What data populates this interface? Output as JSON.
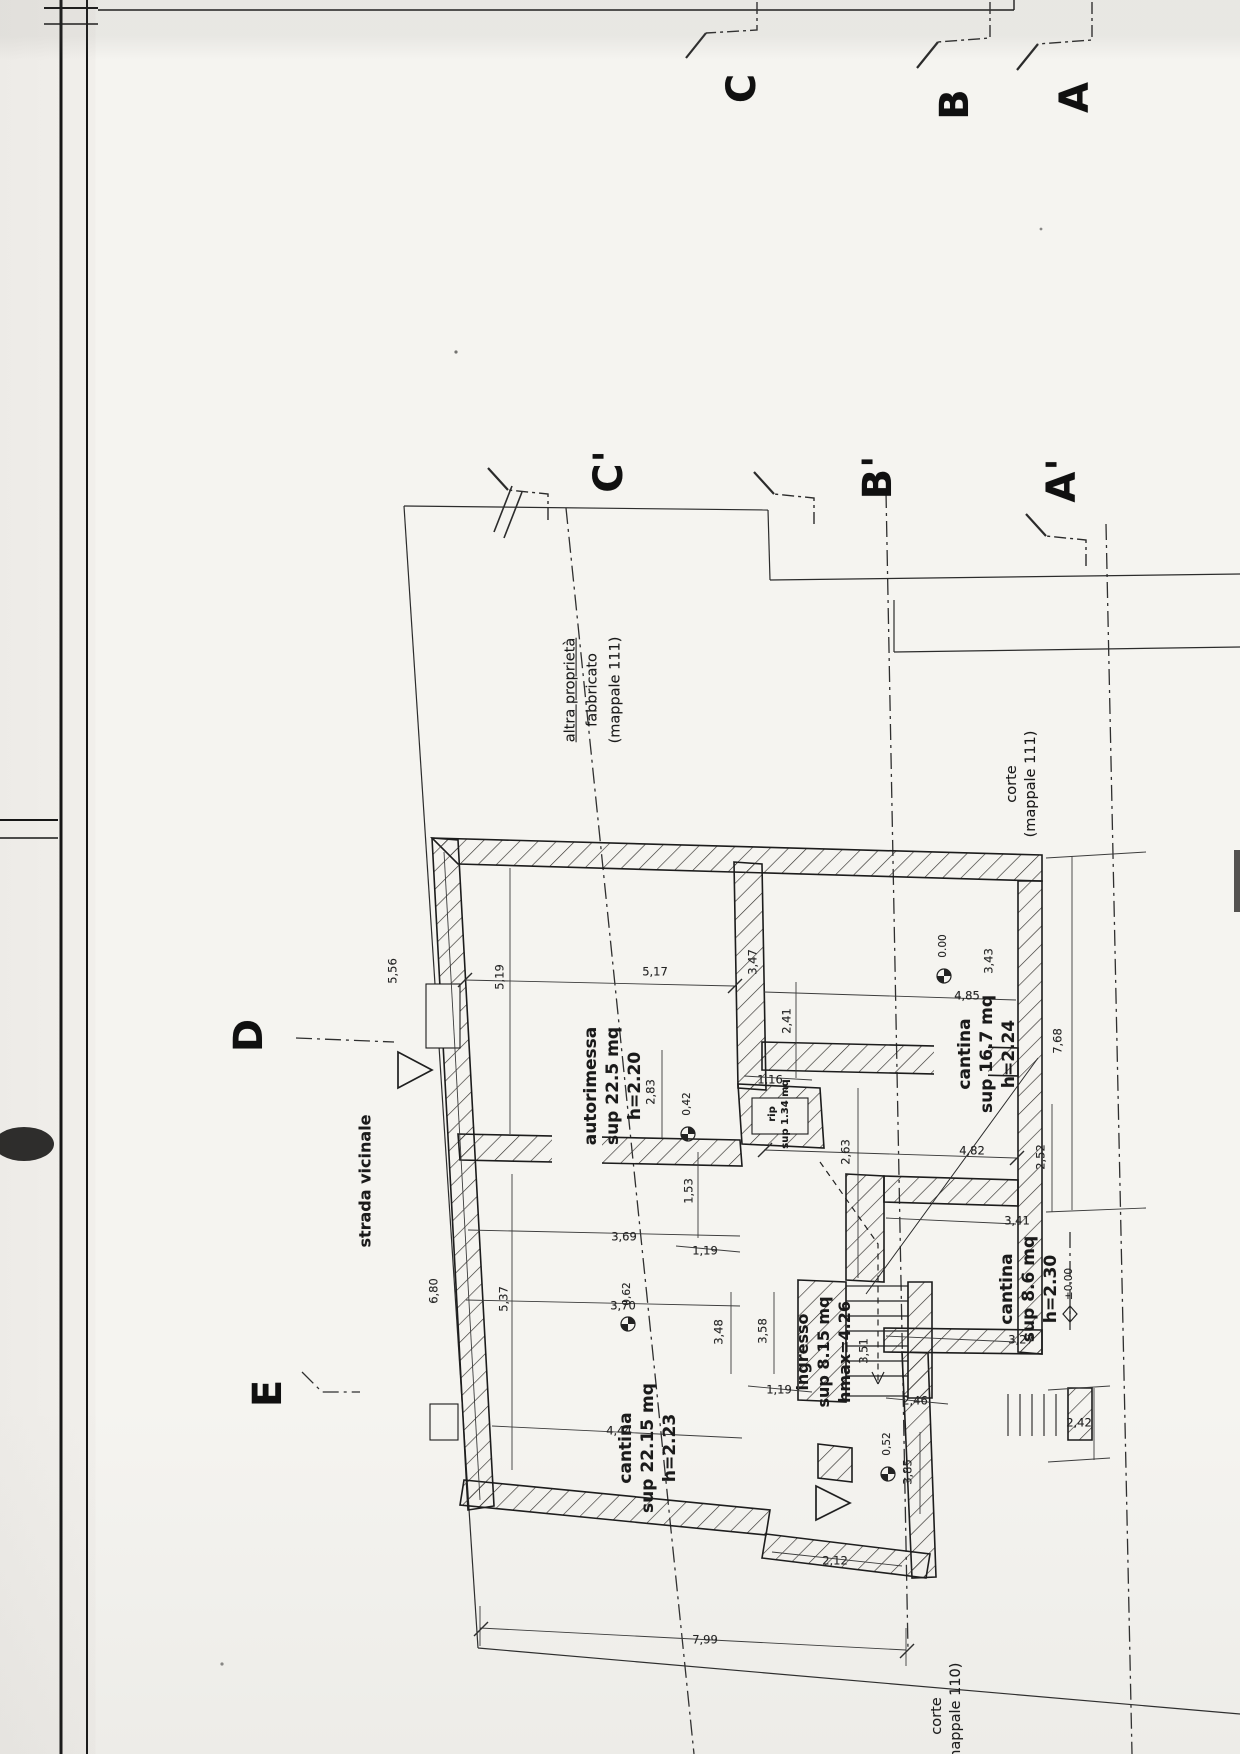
{
  "colors": {
    "paper": "#f5f4f0",
    "ink": "#1a1a1a",
    "line": "#2e2e2e"
  },
  "drawing": {
    "section_letters": [
      {
        "n": "section-letter-c",
        "t": "C",
        "x": 742,
        "y": 88
      },
      {
        "n": "section-letter-b",
        "t": "B",
        "x": 955,
        "y": 104
      },
      {
        "n": "section-letter-a",
        "t": "A",
        "x": 1075,
        "y": 97
      },
      {
        "n": "section-letter-c-prime",
        "t": "C'",
        "x": 609,
        "y": 471
      },
      {
        "n": "section-letter-b-prime",
        "t": "B'",
        "x": 878,
        "y": 477
      },
      {
        "n": "section-letter-a-prime",
        "t": "A'",
        "x": 1062,
        "y": 480
      },
      {
        "n": "section-letter-d",
        "t": "D",
        "x": 249,
        "y": 1035
      },
      {
        "n": "section-letter-e",
        "t": "E",
        "x": 268,
        "y": 1393
      }
    ],
    "rooms": [
      {
        "n": "room-label-autorimessa",
        "lines": [
          "autorimessa",
          "sup 22.5 mq",
          "h=2.20"
        ],
        "x": 613,
        "y": 1086,
        "size": 17
      },
      {
        "n": "room-label-cantina-16-7",
        "lines": [
          "cantina",
          "sup 16.7 mq",
          "h=2.24"
        ],
        "x": 987,
        "y": 1054,
        "size": 17
      },
      {
        "n": "room-label-rip",
        "lines": [
          "rip",
          "sup 1.34 mq"
        ],
        "x": 779,
        "y": 1114,
        "size": 10
      },
      {
        "n": "room-label-cantina-22-15",
        "lines": [
          "cantina",
          "sup 22.15 mq",
          "h=2.23"
        ],
        "x": 648,
        "y": 1448,
        "size": 17
      },
      {
        "n": "room-label-cantina-8-6",
        "lines": [
          "cantina",
          "sup 8.6 mq",
          "h=2.30"
        ],
        "x": 1029,
        "y": 1289,
        "size": 17
      },
      {
        "n": "room-label-ingresso",
        "lines": [
          "ingresso",
          "sup 8.15 mq",
          "hmax=4.26"
        ],
        "x": 824,
        "y": 1352,
        "size": 16
      }
    ],
    "annotations": [
      {
        "n": "label-strada-vicinale",
        "t": "strada vicinale",
        "x": 366,
        "y": 1181,
        "size": 16,
        "bold": true
      },
      {
        "n": "label-altra-proprieta-line1",
        "t": "altra proprietà",
        "x": 571,
        "y": 690,
        "size": 14.5,
        "u": true
      },
      {
        "n": "label-altra-proprieta-line2",
        "t": "fabbricato",
        "x": 593,
        "y": 690,
        "size": 14.5
      },
      {
        "n": "label-altra-proprieta-line3",
        "t": "(mappale 111)",
        "x": 616,
        "y": 690,
        "size": 14.5
      },
      {
        "n": "label-corte-mappale-111",
        "t": "corte\n(mappale 111)",
        "x": 1022,
        "y": 784,
        "size": 14.5
      },
      {
        "n": "label-corte-mappale-110",
        "t": "corte\n(mappale 110)",
        "x": 947,
        "y": 1716,
        "size": 14.5
      }
    ],
    "dimensions": [
      {
        "t": "5,56",
        "x": 393,
        "y": 971,
        "rot": -90
      },
      {
        "t": "6,80",
        "x": 434,
        "y": 1291,
        "rot": -90
      },
      {
        "t": "5,19",
        "x": 500,
        "y": 977,
        "rot": -90
      },
      {
        "t": "5,17",
        "x": 655,
        "y": 972,
        "rot": 0
      },
      {
        "t": "2,41",
        "x": 787,
        "y": 1021,
        "rot": -90
      },
      {
        "t": "3,47",
        "x": 753,
        "y": 962,
        "rot": -90
      },
      {
        "t": "4,85",
        "x": 967,
        "y": 996,
        "rot": 0
      },
      {
        "t": "3,43",
        "x": 989,
        "y": 961,
        "rot": -90
      },
      {
        "t": "7,68",
        "x": 1058,
        "y": 1041,
        "rot": -90
      },
      {
        "t": "1,16",
        "x": 770,
        "y": 1080,
        "rot": 0
      },
      {
        "t": "2,83",
        "x": 651,
        "y": 1092,
        "rot": -90
      },
      {
        "t": "4,82",
        "x": 972,
        "y": 1151,
        "rot": 0
      },
      {
        "t": "2,52",
        "x": 1041,
        "y": 1157,
        "rot": -90
      },
      {
        "t": "2,63",
        "x": 846,
        "y": 1152,
        "rot": -90
      },
      {
        "t": "1,53",
        "x": 689,
        "y": 1191,
        "rot": -90
      },
      {
        "t": "3,41",
        "x": 1017,
        "y": 1221,
        "rot": 0
      },
      {
        "t": "3,69",
        "x": 624,
        "y": 1237,
        "rot": 0
      },
      {
        "t": "1,19",
        "x": 705,
        "y": 1251,
        "rot": 0
      },
      {
        "t": "3,70",
        "x": 623,
        "y": 1306,
        "rot": 0
      },
      {
        "t": "5,37",
        "x": 504,
        "y": 1299,
        "rot": -90
      },
      {
        "t": "3,48",
        "x": 719,
        "y": 1332,
        "rot": -90
      },
      {
        "t": "3,58",
        "x": 763,
        "y": 1331,
        "rot": -90
      },
      {
        "t": "3,27",
        "x": 1021,
        "y": 1340,
        "rot": 0
      },
      {
        "t": "3,51",
        "x": 864,
        "y": 1351,
        "rot": -90
      },
      {
        "t": "1,19",
        "x": 779,
        "y": 1390,
        "rot": 0
      },
      {
        "t": "2,46",
        "x": 915,
        "y": 1401,
        "rot": 0
      },
      {
        "t": "2,42",
        "x": 1079,
        "y": 1423,
        "rot": 0
      },
      {
        "t": "4,44",
        "x": 619,
        "y": 1431,
        "rot": 0
      },
      {
        "t": "3,85",
        "x": 908,
        "y": 1472,
        "rot": -90
      },
      {
        "t": "2,12",
        "x": 835,
        "y": 1561,
        "rot": 0
      },
      {
        "t": "7,99",
        "x": 705,
        "y": 1640,
        "rot": 0
      }
    ],
    "levels": [
      {
        "t": "0,42",
        "x": 688,
        "y": 1104,
        "sym": "target"
      },
      {
        "t": "0.00",
        "x": 944,
        "y": 946,
        "sym": "target"
      },
      {
        "t": "±0.00",
        "x": 1070,
        "y": 1284,
        "sym": "diamond"
      },
      {
        "t": "0,62",
        "x": 628,
        "y": 1294,
        "sym": "target"
      },
      {
        "t": "0,52",
        "x": 888,
        "y": 1444,
        "sym": "target"
      }
    ]
  }
}
